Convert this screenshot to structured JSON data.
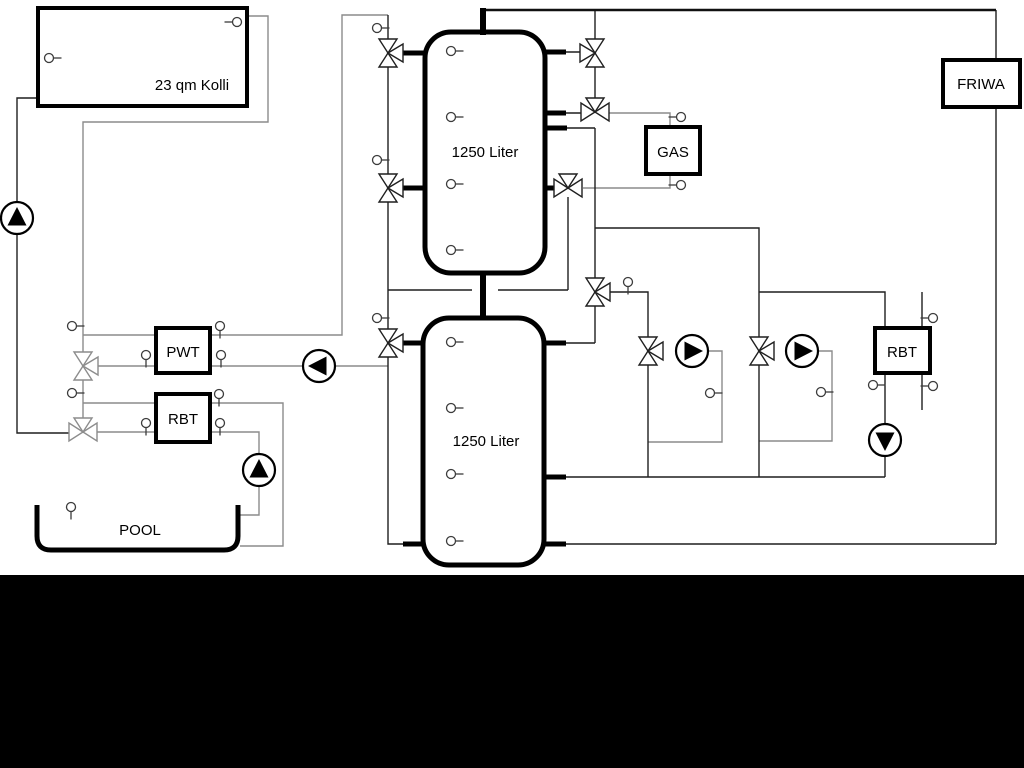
{
  "diagram": {
    "collector": {
      "label": "23 qm Kolli"
    },
    "upper_tank": {
      "label": "1250 Liter"
    },
    "lower_tank": {
      "label": "1250 Liter"
    },
    "pwt": {
      "label": "PWT"
    },
    "rbt_pool": {
      "label": "RBT"
    },
    "gas": {
      "label": "GAS"
    },
    "friwa": {
      "label": "FRIWA"
    },
    "rbt_heating": {
      "label": "RBT"
    },
    "pool": {
      "label": "POOL"
    },
    "colors": {
      "line_dark": "#1f1f1f",
      "line_gray": "#8c8c8c",
      "outline_black": "#000000",
      "background": "#ffffff",
      "bottom_band": "#000000"
    }
  }
}
